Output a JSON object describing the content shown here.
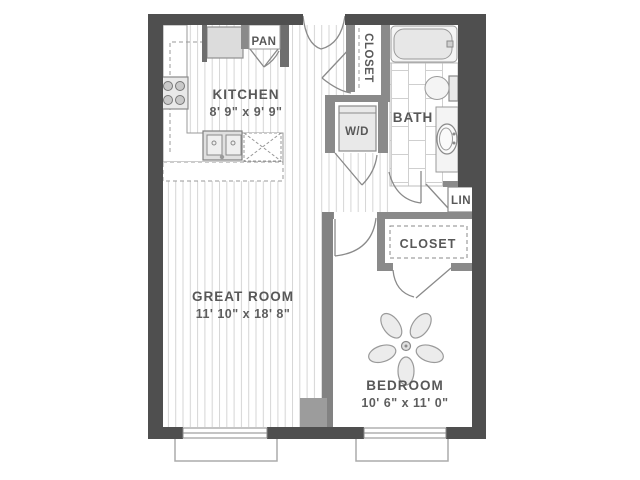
{
  "plan": {
    "type": "apartment-floor-plan",
    "colors": {
      "exterior_wall": "#4f4f4f",
      "interior_wall": "#8a8a8a",
      "fixture_fill": "#e9e9e9",
      "fixture_stroke": "#8a8a8a",
      "floor_line": "#d6d6d6",
      "label_text": "#585858",
      "background": "#ffffff"
    },
    "rooms": {
      "kitchen": {
        "label": "KITCHEN",
        "dims": "8' 9\" x 9' 9\""
      },
      "great_room": {
        "label": "GREAT ROOM",
        "dims": "11' 10\" x 18' 8\""
      },
      "bedroom": {
        "label": "BEDROOM",
        "dims": "10' 6\" x 11' 0\""
      },
      "bath": {
        "label": "BATH"
      },
      "pantry": {
        "label": "PAN"
      },
      "entry_closet": {
        "label": "CLOSET"
      },
      "bedroom_closet": {
        "label": "CLOSET"
      },
      "washer_dryer": {
        "label": "W/D"
      },
      "linen_closet": {
        "label": "LIN"
      }
    },
    "fixtures": [
      "refrigerator",
      "range",
      "kitchen-sink",
      "dishwasher",
      "bathtub",
      "toilet",
      "vanity-sink",
      "washer-dryer",
      "ceiling-fan"
    ]
  }
}
